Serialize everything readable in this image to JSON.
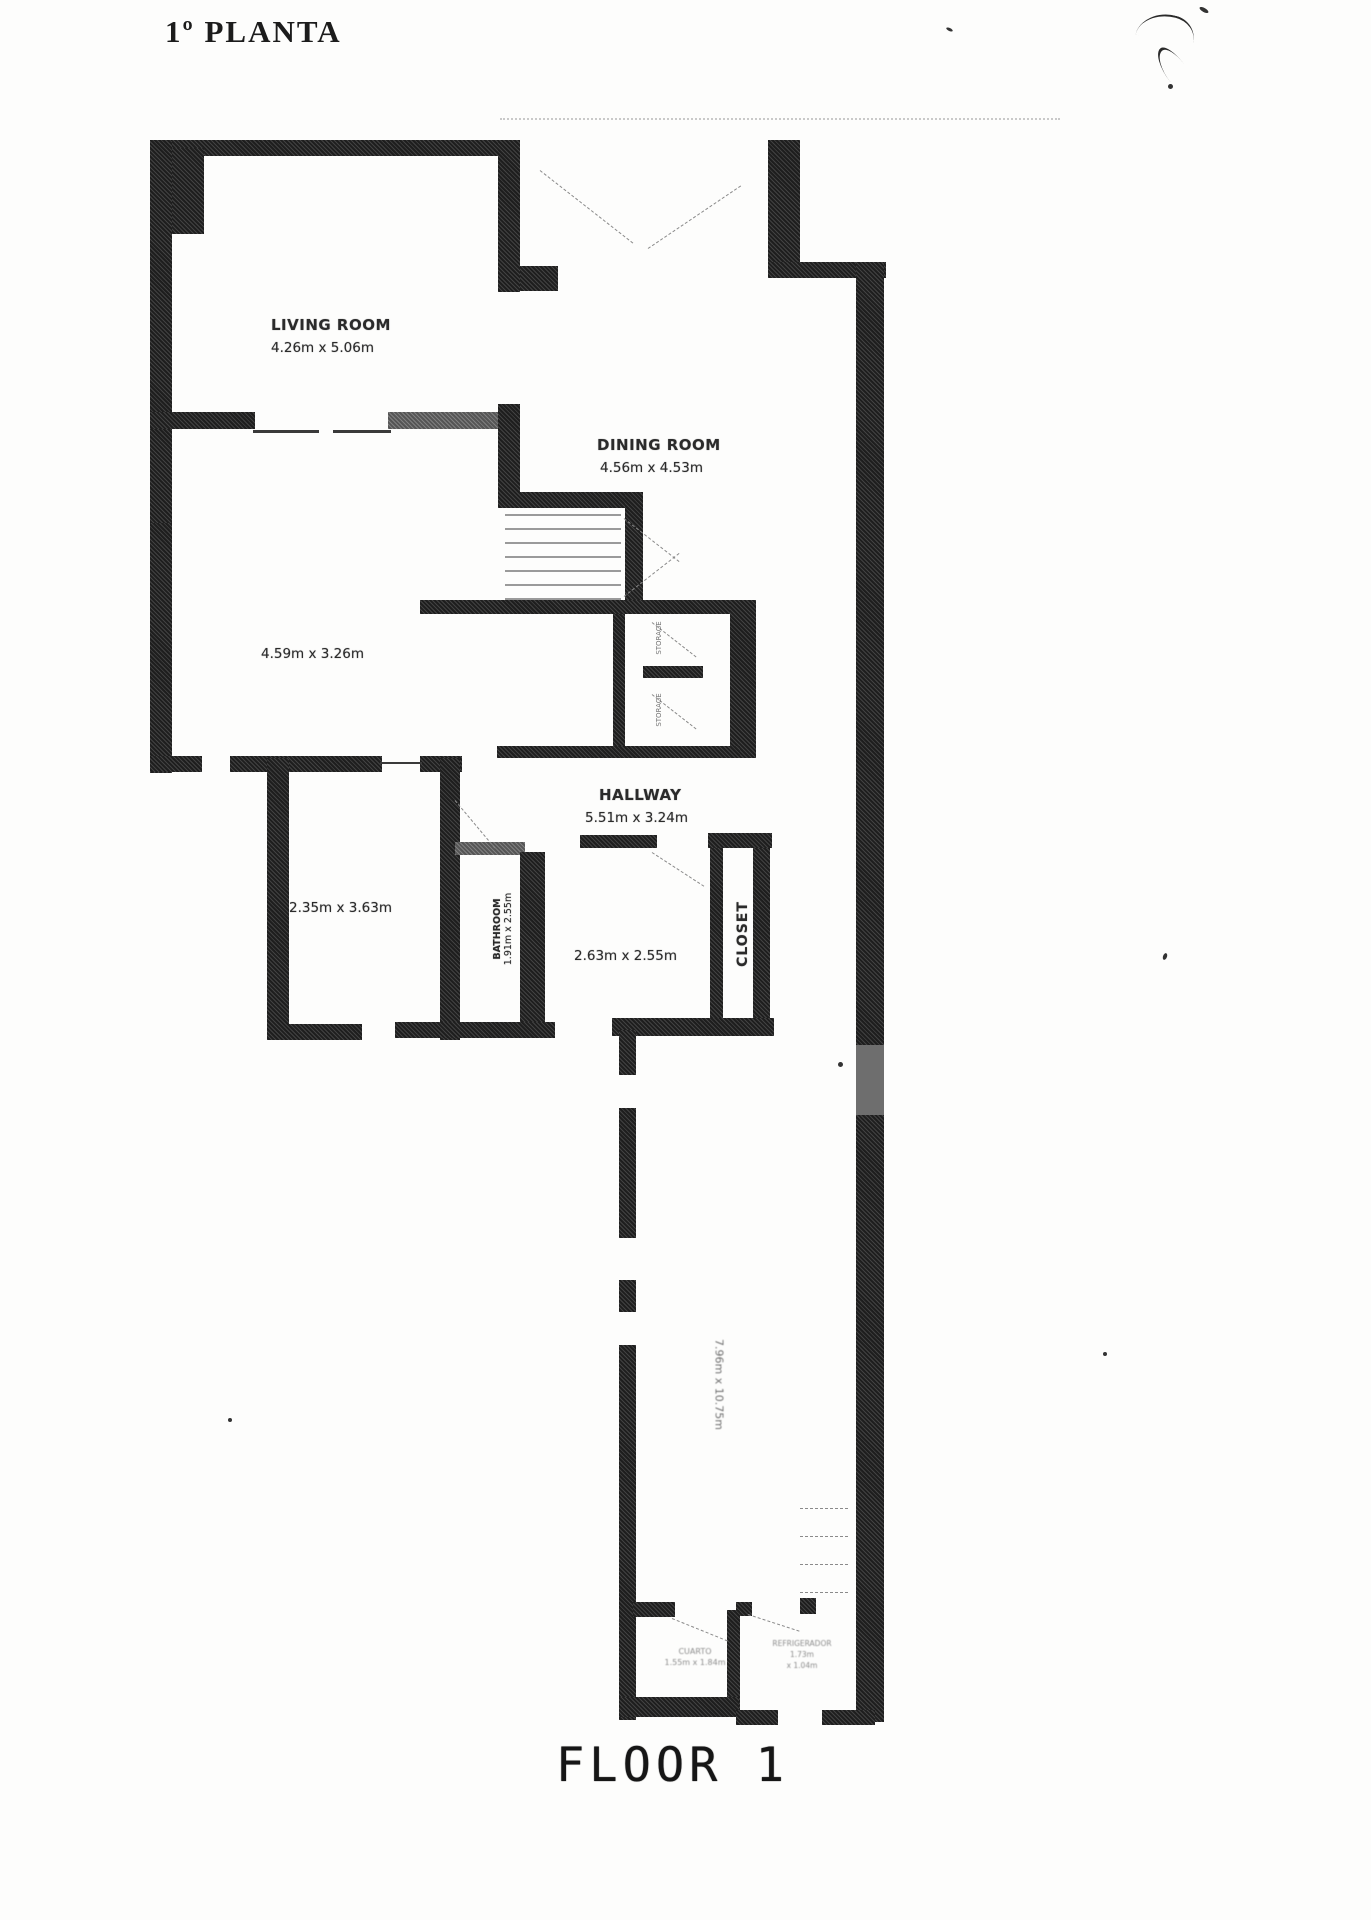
{
  "title": "1º PLANTA",
  "floor_label": "FLOOR 1",
  "rooms": {
    "living": {
      "name": "LIVING ROOM",
      "dims": "4.26m x 5.06m"
    },
    "dining": {
      "name": "DINING ROOM",
      "dims": "4.56m x 4.53m"
    },
    "family": {
      "dims": "4.59m x 3.26m"
    },
    "hallway": {
      "name": "HALLWAY",
      "dims": "5.51m x 3.24m"
    },
    "bedroom_small": {
      "dims": "2.35m x 3.63m"
    },
    "bathroom": {
      "name": "BATHROOM",
      "dims": "1.91m x 2.55m"
    },
    "bedroom": {
      "dims": "2.63m x 2.55m"
    },
    "closet": {
      "name": "CLOSET"
    },
    "storage_upper": {
      "name": "STORAGE"
    },
    "storage_lower": {
      "name": "STORAGE"
    },
    "corridor": {
      "dims": "7.96m x 10.75m"
    },
    "pantry": {
      "line1": "CUARTO",
      "line2": "1.55m x 1.84m"
    },
    "fridge_nook": {
      "line1": "REFRIGERADOR",
      "line2": "1.73m",
      "line3": "x 1.04m"
    }
  },
  "colors": {
    "wall": "#1e1e1e",
    "text": "#2b2b2b"
  }
}
